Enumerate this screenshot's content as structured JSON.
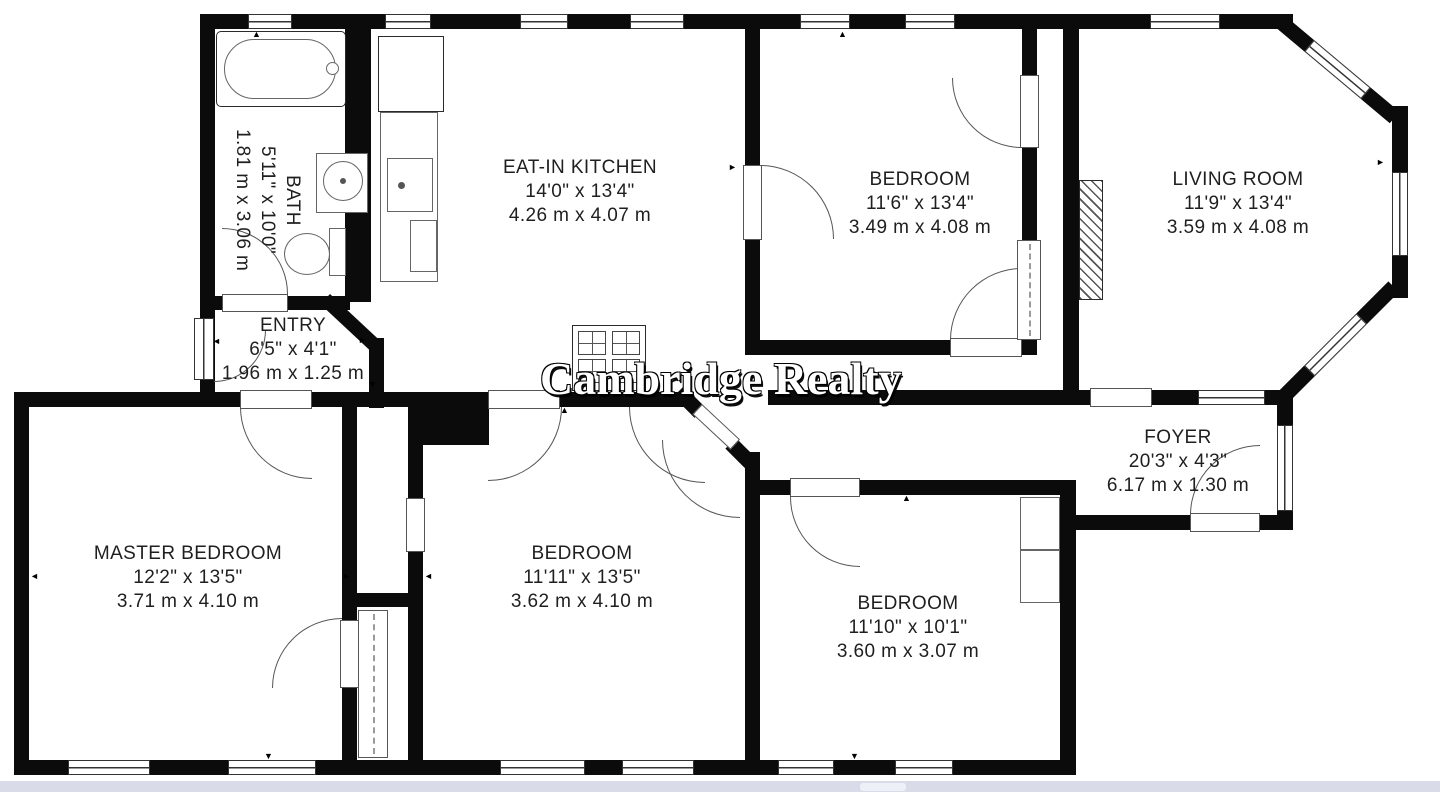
{
  "watermark": "Cambridge Realty",
  "rooms": [
    {
      "id": "bath",
      "name": "BATH",
      "imperial": "5'11\" x 10'0\"",
      "metric": "1.81 m x 3.06 m"
    },
    {
      "id": "kitchen",
      "name": "EAT-IN KITCHEN",
      "imperial": "14'0\" x 13'4\"",
      "metric": "4.26 m x 4.07 m"
    },
    {
      "id": "entry",
      "name": "ENTRY",
      "imperial": "6'5\" x 4'1\"",
      "metric": "1.96 m x 1.25 m"
    },
    {
      "id": "bedroom-top",
      "name": "BEDROOM",
      "imperial": "11'6\" x 13'4\"",
      "metric": "3.49 m x 4.08 m"
    },
    {
      "id": "living-room",
      "name": "LIVING ROOM",
      "imperial": "11'9\" x 13'4\"",
      "metric": "3.59 m x 4.08 m"
    },
    {
      "id": "foyer",
      "name": "FOYER",
      "imperial": "20'3\" x 4'3\"",
      "metric": "6.17 m x 1.30 m"
    },
    {
      "id": "master-bedroom",
      "name": "MASTER BEDROOM",
      "imperial": "12'2\" x 13'5\"",
      "metric": "3.71 m x 4.10 m"
    },
    {
      "id": "bedroom-mid",
      "name": "BEDROOM",
      "imperial": "11'11\" x 13'5\"",
      "metric": "3.62 m x 4.10 m"
    },
    {
      "id": "bedroom-right",
      "name": "BEDROOM",
      "imperial": "11'10\" x 10'1\"",
      "metric": "3.60 m x 3.07 m"
    }
  ],
  "icons": {
    "arrow_up": "▲",
    "arrow_down": "▼",
    "arrow_left": "◄",
    "arrow_right": "►"
  },
  "colors": {
    "wall": "#0b0b0b",
    "line": "#333333",
    "text": "#1f1f1f",
    "watermark": "#ffffff",
    "footer_bar": "#d9dbe9"
  }
}
